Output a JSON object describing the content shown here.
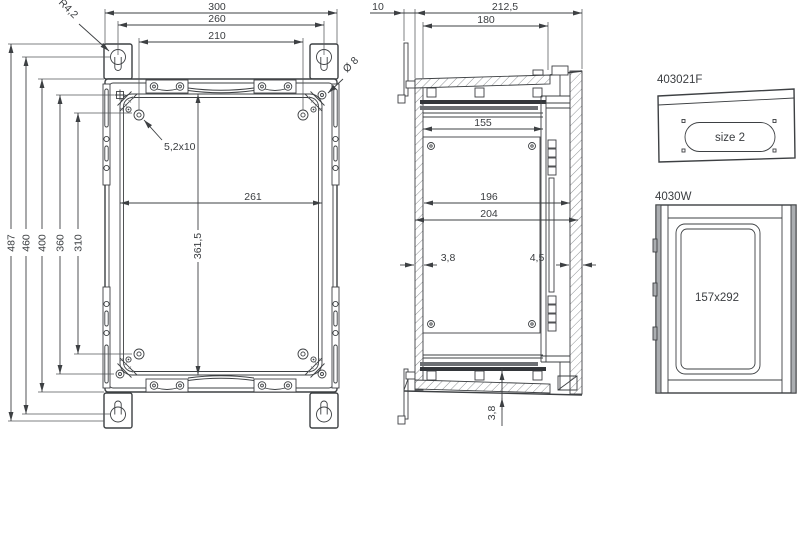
{
  "front": {
    "d300": "300",
    "d260": "260",
    "d210": "210",
    "d261": "261",
    "d361_5": "361,5",
    "d487": "487",
    "d460": "460",
    "d400": "400",
    "d360": "360",
    "d310": "310",
    "corner_radius": "R4,2",
    "hole_dia": "Ø 8",
    "slot_size": "5,2x10"
  },
  "side": {
    "d10": "10",
    "d212_5": "212,5",
    "d180": "180",
    "d155": "155",
    "d196": "196",
    "d204": "204",
    "wall_back": "3,8",
    "wall_front": "4,5",
    "lid_gap": "3,8"
  },
  "details": {
    "flange_label": "403021F",
    "flange_size": "size 2",
    "window_label": "4030W",
    "window_size": "157x292"
  }
}
